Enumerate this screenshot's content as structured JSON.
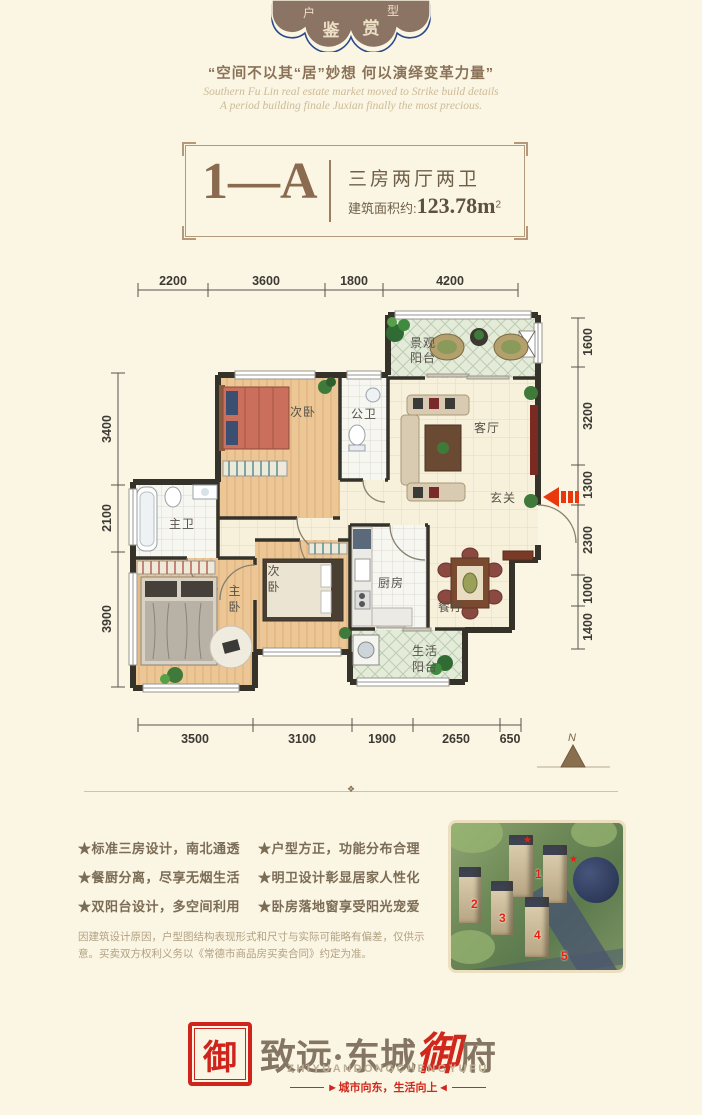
{
  "colors": {
    "accent_red": "#e8380d",
    "badge_blue": "#2b4a8e",
    "brown": "#8a6f52",
    "seal_red": "#cf241c"
  },
  "badge": {
    "top_left": "户",
    "top_right": "型",
    "main_left": "鉴",
    "main_right": "赏"
  },
  "tagline": {
    "cn": "“空间不以其“居”妙想 何以演绎变革力量”",
    "en1": "Southern Fu Lin real estate market moved to Strike build details",
    "en2": "A period building finale Juxian finally the most precious."
  },
  "title_box": {
    "unit": "1—A",
    "type": "三房两厅两卫",
    "area_label": "建筑面积约:",
    "area_value": "123.78m",
    "area_sup": "2"
  },
  "plan": {
    "dims_top": [
      "2200",
      "3600",
      "1800",
      "4200"
    ],
    "dims_left": [
      "3400",
      "2100",
      "3900"
    ],
    "dims_right": [
      "1600",
      "3200",
      "1300",
      "2300",
      "1000",
      "1400"
    ],
    "dims_bottom": [
      "3500",
      "3100",
      "1900",
      "2650",
      "650"
    ],
    "rooms": {
      "bedroom_top": "次卧",
      "bath_guest": "公卫",
      "balcony_view_l1": "景观",
      "balcony_view_l2": "阳台",
      "living": "客厅",
      "entry": "玄关",
      "bath_master": "主卫",
      "bedroom_master_c1": "主",
      "bedroom_master_c2": "卧",
      "bedroom_second_c1": "次",
      "bedroom_second_c2": "卧",
      "kitchen": "厨房",
      "dining": "餐厅",
      "balcony_life_l1": "生活",
      "balcony_life_l2": "阳台"
    },
    "compass_n": "N"
  },
  "features": {
    "left": [
      "★标准三房设计，南北通透",
      "★餐厨分离，尽享无烟生活",
      "★双阳台设计，多空间利用"
    ],
    "right": [
      "★户型方正，功能分布合理",
      "★明卫设计彰显居家人性化",
      "★卧房落地窗享受阳光宠爱"
    ]
  },
  "disclaimer": "因建筑设计原因，户型图结构表现形式和尺寸与实际可能略有偏差，仅供示意。买卖双方权利义务以《常德市商品房买卖合同》约定为准。",
  "site_plan": {
    "numbers": [
      "1",
      "2",
      "3",
      "4",
      "5"
    ],
    "star": "★"
  },
  "icons": {
    "arrow_right": "▶",
    "arrow_left": "◀",
    "divider_ornament": "❖"
  },
  "logo": {
    "seal_char": "御",
    "name_pre": "致远·东城",
    "name_accent": "御",
    "name_post": "府",
    "subtitle": "ZHIYUANDONGCHENGYUFU",
    "slogan": "城市向东，生活向上"
  }
}
